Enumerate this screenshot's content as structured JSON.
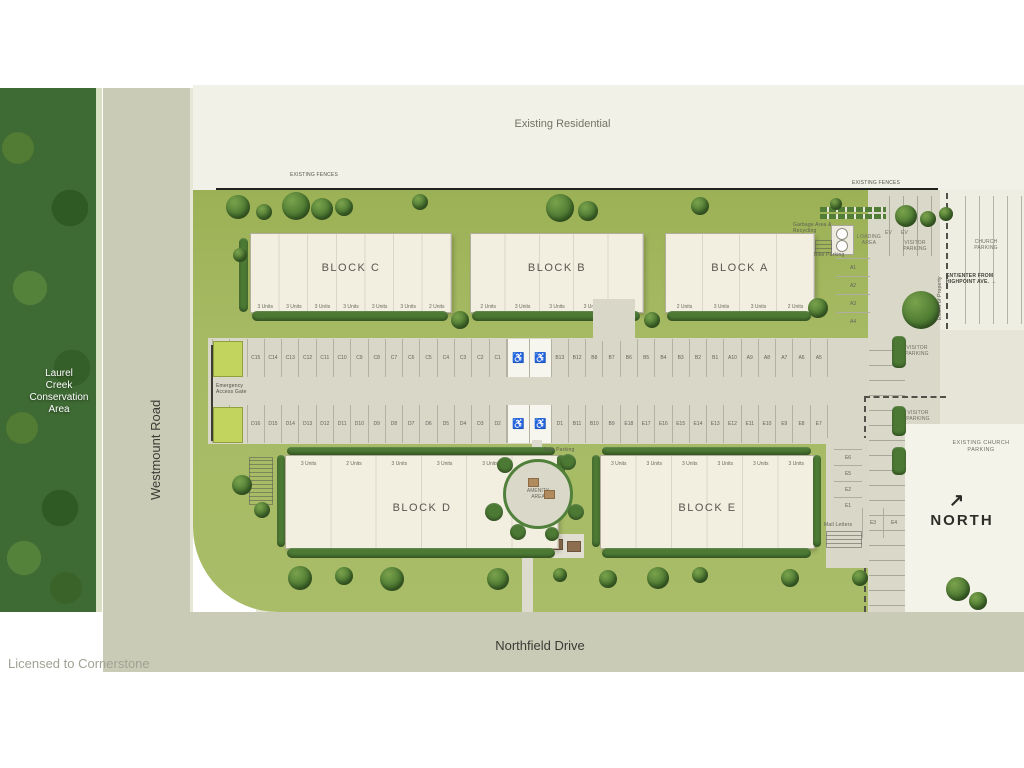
{
  "watermark": "Licensed to Cornerstone",
  "roads": {
    "westmount": "Westmount Road",
    "northfield": "Northfield Drive"
  },
  "areas": {
    "existing_residential": "Existing Residential",
    "conservation_lines": [
      "Laurel",
      "Creek",
      "Conservation",
      "Area"
    ],
    "existing_fences": "EXISTING FENCES",
    "amenity": "AMENITY AREA",
    "existing_church_parking": "EXISTING CHURCH PARKING",
    "north_label": "NORTH",
    "north_arrow": "↗"
  },
  "blocks": [
    {
      "id": "C",
      "label": "BLOCK C",
      "units": [
        "3 Units",
        "3 Units",
        "3 Units",
        "3 Units",
        "3 Units",
        "3 Units",
        "2 Units"
      ]
    },
    {
      "id": "B",
      "label": "BLOCK B",
      "units": [
        "2 Units",
        "3 Units",
        "3 Units",
        "3 Units",
        "2 Units"
      ]
    },
    {
      "id": "A",
      "label": "BLOCK A",
      "units": [
        "2 Units",
        "3 Units",
        "3 Units",
        "2 Units"
      ]
    },
    {
      "id": "D",
      "label": "BLOCK D",
      "units": [
        "3 Units",
        "2 Units",
        "3 Units",
        "3 Units",
        "3 Units",
        "3 Units"
      ]
    },
    {
      "id": "E",
      "label": "BLOCK E",
      "units": [
        "3 Units",
        "3 Units",
        "3 Units",
        "3 Units",
        "3 Units",
        "3 Units"
      ]
    }
  ],
  "parking": {
    "accessible_icon": "♿",
    "row_top_left": [
      "C17",
      "C16",
      "C15",
      "C14",
      "C13",
      "C12",
      "C11",
      "C10",
      "C9",
      "C8",
      "C7",
      "C6",
      "C5",
      "C4",
      "C3",
      "C2",
      "C1"
    ],
    "row_top_right": [
      "B13",
      "B12",
      "B8",
      "B7",
      "B6",
      "B5",
      "B4",
      "B3",
      "B2",
      "B1",
      "A10",
      "A9",
      "A8",
      "A7",
      "A6",
      "A5"
    ],
    "row_bottom_left": [
      "D18",
      "D17",
      "D16",
      "D15",
      "D14",
      "D13",
      "D12",
      "D11",
      "D10",
      "D9",
      "D8",
      "D7",
      "D6",
      "D5",
      "D4",
      "D3",
      "D2"
    ],
    "row_bottom_right": [
      "D1",
      "B11",
      "B10",
      "B9",
      "E18",
      "E17",
      "E16",
      "E15",
      "E14",
      "E13",
      "E12",
      "E11",
      "E10",
      "E9",
      "E8",
      "E7"
    ],
    "north_stalls": [
      "A1",
      "A2",
      "A3",
      "A4"
    ],
    "east_stalls": [
      "E6",
      "E5",
      "E2",
      "E1"
    ],
    "east_pair": [
      "E3",
      "E4"
    ]
  },
  "labels": {
    "emergency_gate": "Emergency Access Gate",
    "garbage": "Garbage Area & Recycling",
    "bike_parking": "Bike Parking",
    "loading_area": "LOADING AREA",
    "ev": "EV",
    "visitor_parking": "VISITOR PARKING",
    "church_parking": "CHURCH PARKING",
    "enter_highpoint": "ENT/ENTER FROM HIGHPOINT AVE. →",
    "extent_of_property": "Extent of Property",
    "mail": "Mail Letters"
  },
  "colors": {
    "lawn": "#a7bb65",
    "road": "#c9cbb6",
    "asphalt": "#d8d7c8",
    "building": "#f2eee0",
    "conservation": "#3e6a33",
    "hedge": "#4c7a34",
    "residential": "#f1f1e8"
  }
}
